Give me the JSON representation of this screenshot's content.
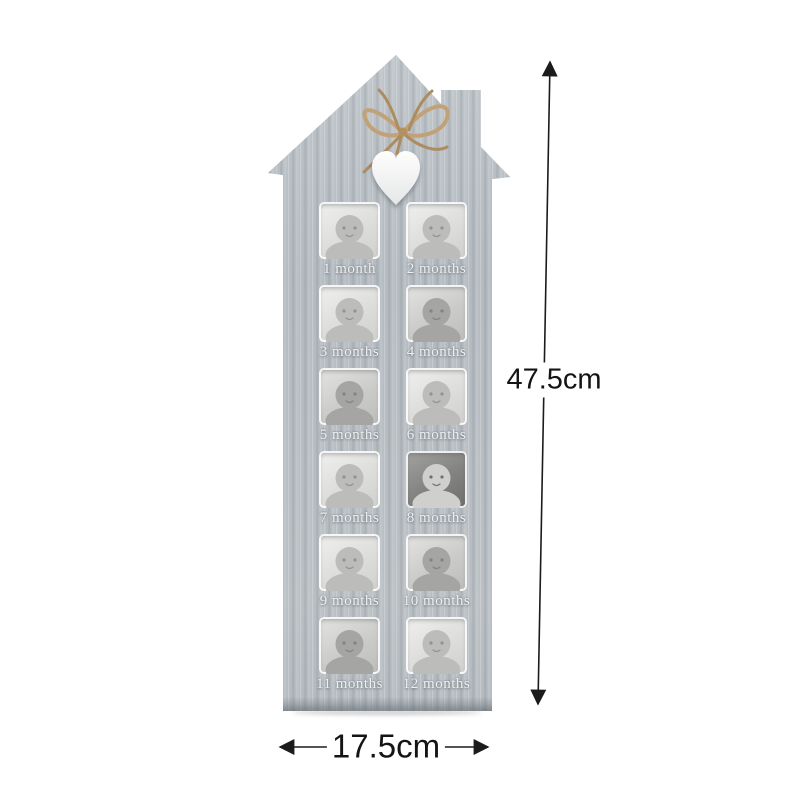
{
  "product": {
    "description": "house-shaped wooden 12-month baby photo frame",
    "frame_color": "#b6bcc1",
    "heart_color": "#f6f6f5",
    "twine_color": "#c2a176",
    "engraved_text_color": "#edf0f0"
  },
  "frame": {
    "slots": [
      {
        "label": "1 month",
        "tone": "light",
        "photo": "newborn-sleeping-closeup"
      },
      {
        "label": "2 months",
        "tone": "light",
        "photo": "baby-lying-on-blanket"
      },
      {
        "label": "3 months",
        "tone": "light",
        "photo": "baby-crawling-looking-up"
      },
      {
        "label": "4 months",
        "tone": "mid",
        "photo": "baby-wearing-white-hat"
      },
      {
        "label": "5 months",
        "tone": "mid",
        "photo": "baby-closeup-hand-in-mouth"
      },
      {
        "label": "6 months",
        "tone": "light",
        "photo": "baby-sitting"
      },
      {
        "label": "7 months",
        "tone": "light",
        "photo": "baby-lying-with-toy"
      },
      {
        "label": "8 months",
        "tone": "dark",
        "photo": "baby-with-dark-headband"
      },
      {
        "label": "9 months",
        "tone": "light",
        "photo": "baby-sitting-up"
      },
      {
        "label": "10 months",
        "tone": "mid",
        "photo": "baby-holding-cup"
      },
      {
        "label": "11 months",
        "tone": "mid",
        "photo": "baby-dark-hair-smiling"
      },
      {
        "label": "12 months",
        "tone": "light",
        "photo": "baby-laughing-open-mouth"
      }
    ]
  },
  "dimensions": {
    "height_label": "47.5cm",
    "width_label": "17.5cm"
  }
}
